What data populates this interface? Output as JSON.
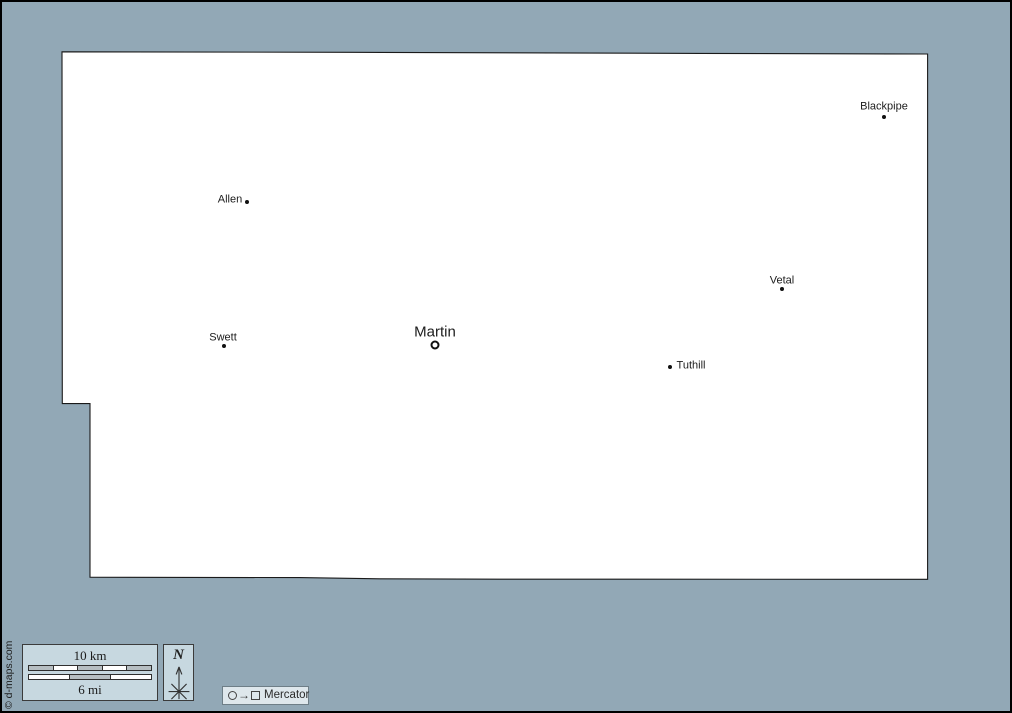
{
  "map": {
    "towns": [
      {
        "name": "Blackpipe",
        "marker": "dot",
        "dot": {
          "x": 882,
          "y": 115
        },
        "label": {
          "x": 882,
          "y": 105
        },
        "font": 11
      },
      {
        "name": "Allen",
        "marker": "dot",
        "dot": {
          "x": 245,
          "y": 200
        },
        "label": {
          "x": 228,
          "y": 198
        },
        "font": 11
      },
      {
        "name": "Vetal",
        "marker": "dot",
        "dot": {
          "x": 780,
          "y": 287
        },
        "label": {
          "x": 780,
          "y": 279
        },
        "font": 11
      },
      {
        "name": "Swett",
        "marker": "dot",
        "dot": {
          "x": 222,
          "y": 344
        },
        "label": {
          "x": 221,
          "y": 336
        },
        "font": 11
      },
      {
        "name": "Martin",
        "marker": "ring",
        "dot": {
          "x": 433,
          "y": 343
        },
        "label": {
          "x": 433,
          "y": 330
        },
        "font": 15
      },
      {
        "name": "Tuthill",
        "marker": "dot",
        "dot": {
          "x": 668,
          "y": 365
        },
        "label": {
          "x": 689,
          "y": 364
        },
        "font": 11
      }
    ]
  },
  "scale_bar": {
    "km_label": "10 km",
    "mi_label": "6 mi",
    "km_segments": [
      "#b6bec2",
      "#ffffff",
      "#b6bec2",
      "#ffffff",
      "#b6bec2"
    ],
    "mi_segments": [
      "#ffffff",
      "#b6bec2",
      "#ffffff"
    ]
  },
  "compass": {
    "label": "N"
  },
  "projection": {
    "label": "Mercator",
    "arrow_glyph": "→"
  },
  "copyright": "© d-maps.com",
  "colors": {
    "background": "#92a8b6",
    "panel": "#c7d8e0",
    "badge": "#dee7ec",
    "county_fill": "#ffffff",
    "county_stroke": "#1a1a1a"
  }
}
